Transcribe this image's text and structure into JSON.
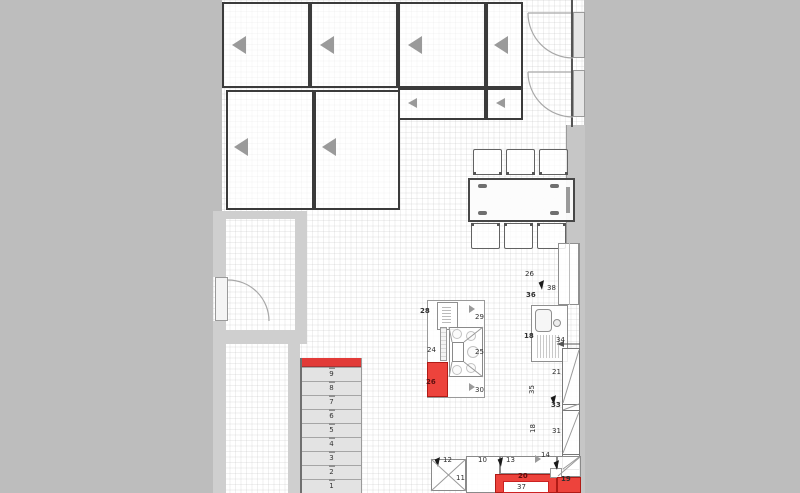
{
  "colors": {
    "background": "#bdbdbd",
    "wall": "#cfcfcf",
    "floor": "#ffffff",
    "accent_red": "#ed433c",
    "cabinet_border": "#3b3b3b",
    "step_fill": "#e3e3e3",
    "door_arrow_gray": "#9a9a9a"
  },
  "icons": {
    "door_direction": "left-triangle",
    "direction_marker": "right-triangle",
    "selection_cursor": "pointer-triangle"
  },
  "stairs": {
    "steps": [
      "9",
      "8",
      "7",
      "6",
      "5",
      "4",
      "3",
      "2",
      "1"
    ]
  },
  "item_labels": [
    {
      "t": "28",
      "x": 420,
      "y": 307,
      "b": 1
    },
    {
      "t": "29",
      "x": 475,
      "y": 313
    },
    {
      "t": "24",
      "x": 427,
      "y": 346
    },
    {
      "t": "25",
      "x": 475,
      "y": 348
    },
    {
      "t": "26",
      "x": 426,
      "y": 378,
      "b": 1,
      "c": "#5d0f0f"
    },
    {
      "t": "30",
      "x": 475,
      "y": 386
    },
    {
      "t": "26",
      "x": 525,
      "y": 270
    },
    {
      "t": "38",
      "x": 547,
      "y": 284
    },
    {
      "t": "36",
      "x": 526,
      "y": 291,
      "b": 1
    },
    {
      "t": "18",
      "x": 524,
      "y": 332,
      "b": 1
    },
    {
      "t": "34",
      "x": 556,
      "y": 336
    },
    {
      "t": "21",
      "x": 552,
      "y": 368
    },
    {
      "t": "35",
      "x": 528,
      "y": 394,
      "r": 1
    },
    {
      "t": "33",
      "x": 551,
      "y": 401,
      "b": 1
    },
    {
      "t": "18",
      "x": 529,
      "y": 433,
      "r": 1
    },
    {
      "t": "31",
      "x": 552,
      "y": 427
    },
    {
      "t": "14",
      "x": 541,
      "y": 451
    },
    {
      "t": "12",
      "x": 443,
      "y": 456
    },
    {
      "t": "10",
      "x": 478,
      "y": 456
    },
    {
      "t": "11",
      "x": 456,
      "y": 474
    },
    {
      "t": "13",
      "x": 506,
      "y": 456
    },
    {
      "t": "20",
      "x": 518,
      "y": 472,
      "b": 1,
      "c": "#5d0f0f"
    },
    {
      "t": "37",
      "x": 517,
      "y": 483
    },
    {
      "t": "19",
      "x": 561,
      "y": 475,
      "b": 1
    }
  ]
}
